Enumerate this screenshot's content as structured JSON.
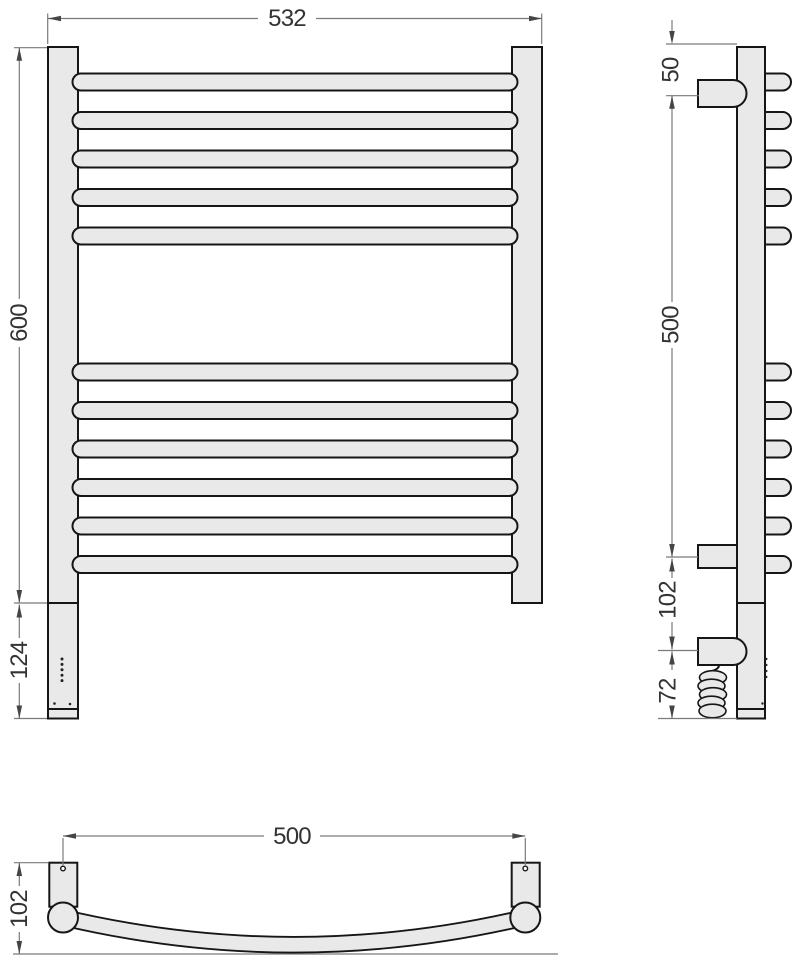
{
  "colors": {
    "background": "#ffffff",
    "part_fill": "#e9e9e9",
    "part_outline": "#161616",
    "dimension_line": "#7a7a7a",
    "dimension_text": "#333333"
  },
  "views": {
    "front": {
      "dims": {
        "overall_width": "532",
        "rail_height": "600",
        "heater_module_height": "124"
      }
    },
    "side": {
      "dims": {
        "top_to_bracket": "50",
        "bracket_span": "500",
        "bracket_to_heater": "102",
        "heater_to_bottom": "72"
      }
    },
    "plan": {
      "dims": {
        "bracket_spacing": "500",
        "depth_from_wall": "102"
      }
    }
  }
}
